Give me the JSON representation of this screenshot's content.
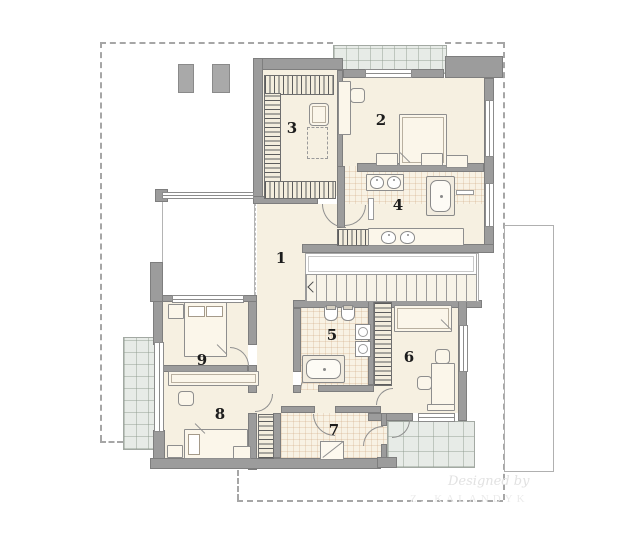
{
  "rooms": [
    {
      "label": "1"
    },
    {
      "label": "2"
    },
    {
      "label": "3"
    },
    {
      "label": "4"
    },
    {
      "label": "5"
    },
    {
      "label": "6"
    },
    {
      "label": "7"
    },
    {
      "label": "8"
    },
    {
      "label": "9"
    }
  ],
  "watermark": {
    "line1": "Designed by",
    "line2": "Z. KALANDYK"
  },
  "colors": {
    "floor": "#f6f0e1",
    "tile_floor": "#f8f2e4",
    "wall": "#9c9c9c",
    "terrace": "#e7ebe7",
    "roof_outline": "#a6a6a6",
    "room_number": "#1c1c1c"
  }
}
